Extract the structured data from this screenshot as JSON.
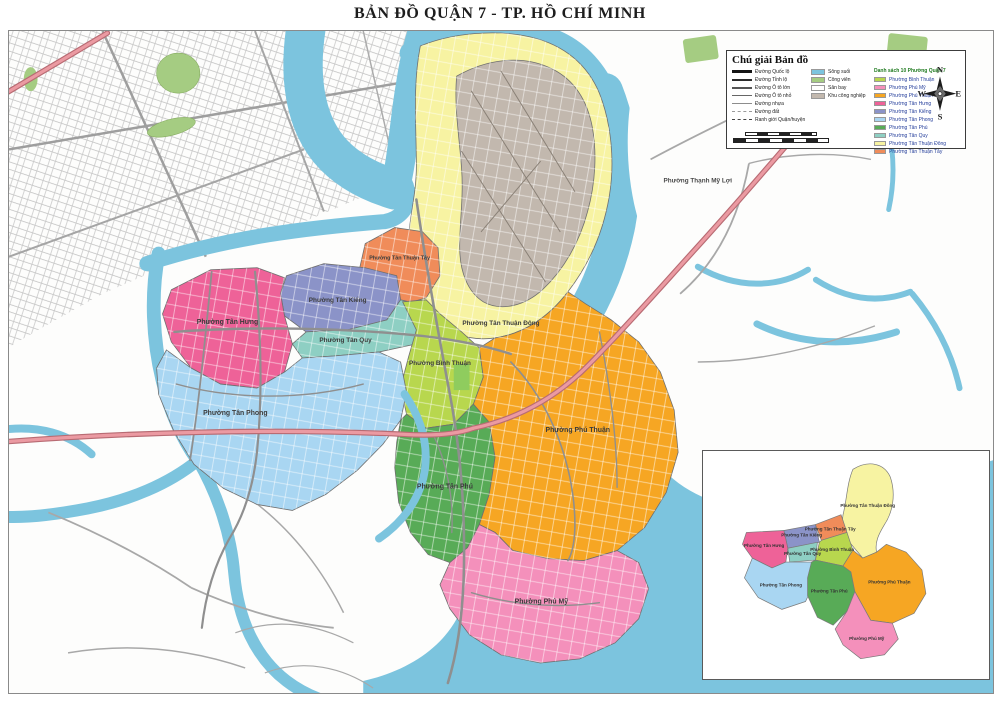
{
  "title": "BẢN ĐỒ QUẬN 7 - TP. HỒ CHÍ MINH",
  "legend": {
    "title": "Chú giải Bản đồ",
    "roads": [
      {
        "label": "Đường Quốc lộ"
      },
      {
        "label": "Đường Tỉnh lộ"
      },
      {
        "label": "Đường Ô tô lớn"
      },
      {
        "label": "Đường Ô tô nhỏ"
      },
      {
        "label": "Đường nhựa"
      },
      {
        "label": "Đường đất"
      },
      {
        "label": "Ranh giới Quận/huyện"
      }
    ],
    "areas": [
      {
        "label": "Sông suối",
        "color": "#7cc4de"
      },
      {
        "label": "Công viên",
        "color": "#a5cc82"
      },
      {
        "label": "Sân bay",
        "color": "#ffffff"
      },
      {
        "label": "Khu công nghiệp",
        "color": "#c2b8ae"
      }
    ],
    "ward_list_title": "Danh sách 10 Phường Quận 7",
    "wards": [
      {
        "name": "Phường Bình Thuận",
        "color": "#b8d74e"
      },
      {
        "name": "Phường Phú Mỹ",
        "color": "#f490bb"
      },
      {
        "name": "Phường Phú Thuận",
        "color": "#f6a623"
      },
      {
        "name": "Phường Tân Hưng",
        "color": "#ee6298"
      },
      {
        "name": "Phường Tân Kiểng",
        "color": "#8b93c8"
      },
      {
        "name": "Phường Tân Phong",
        "color": "#a9d6f2"
      },
      {
        "name": "Phường Tân Phú",
        "color": "#58ab57"
      },
      {
        "name": "Phường Tân Quy",
        "color": "#8ecfc3"
      },
      {
        "name": "Phường Tân Thuận Đông",
        "color": "#f7f3a2"
      },
      {
        "name": "Phường Tân Thuận Tây",
        "color": "#f08c5a"
      }
    ]
  },
  "compass": {
    "n": "N",
    "e": "E",
    "s": "S",
    "w": "W"
  },
  "map_labels": [
    "Phường Tân Hưng",
    "Phường Tân Kiểng",
    "Phường Tân Quy",
    "Phường Tân Thuận Tây",
    "Phường Tân Thuận Đông",
    "Phường Bình Thuận",
    "Phường Tân Phong",
    "Phường Tân Phú",
    "Phường Phú Thuận",
    "Phường Phú Mỹ",
    "Phường Thạnh Mỹ Lợi"
  ],
  "inset_labels": [
    "Phường Tân Thuận Đông",
    "Phường Tân Thuận Tây",
    "Phường Tân Kiểng",
    "Phường Tân Hưng",
    "Phường Tân Quy",
    "Phường Bình Thuận",
    "Phường Tân Phong",
    "Phường Tân Phú",
    "Phường Phú Thuận",
    "Phường Phú Mỹ"
  ]
}
